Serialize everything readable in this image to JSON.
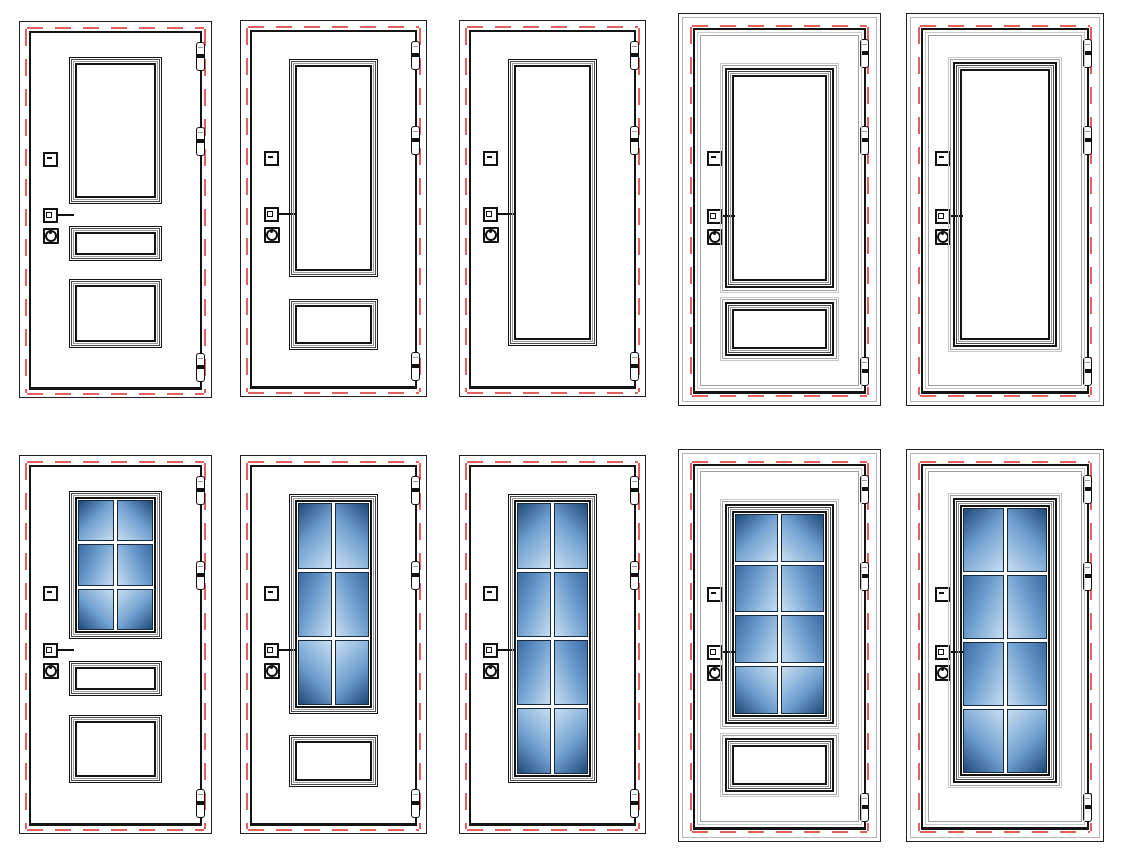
{
  "canvas": {
    "width": 1124,
    "height": 854,
    "background": "#ffffff"
  },
  "image_type": "technical-drawing-catalog",
  "subject": "entry-door-design-variants",
  "grid": {
    "rows": 2,
    "cols": 5
  },
  "colors": {
    "frame_line": "#202020",
    "leaf_line": "#141414",
    "molding_light": "#c8c8c8",
    "molding_mid": "#9f9f9f",
    "ring_dark": "#141414",
    "ring_mid": "#4a4a4a",
    "ring_gray": "#9a9a9a",
    "gasket_red": "#e26060",
    "glass_dark": "#1e4976",
    "glass_middark": "#3a6aa2",
    "glass_mid": "#6f9fcf",
    "glass_light": "#c6ddf1",
    "muntin_white": "#ffffff",
    "hardware_black": "#111111"
  },
  "door_common": {
    "hinge_count": 3,
    "hinge_side": "right",
    "hardware": [
      "latch",
      "lever-handle",
      "cylinder-lock"
    ],
    "hardware_side": "left",
    "seal": "red-dashed-gasket",
    "hinge_tops_pct": [
      2.5,
      26.5,
      90.5
    ],
    "latch_top_pct": 33.5,
    "handle_top_pct": 49.5,
    "lock_top_pct": 55.0
  },
  "doors": [
    {
      "id": 1,
      "name": "door-three-blank-panels",
      "style": "plain",
      "row": 1,
      "col": 1,
      "cell": {
        "x": 19,
        "y": 21,
        "w": 193,
        "h": 377
      },
      "panels": [
        {
          "kind": "blank",
          "top_pct": 6.7,
          "height_pct": 41.6
        },
        {
          "kind": "blank",
          "top_pct": 54.5,
          "height_pct": 9.8
        },
        {
          "kind": "blank",
          "top_pct": 69.6,
          "height_pct": 19.3
        }
      ]
    },
    {
      "id": 2,
      "name": "door-two-blank-panels",
      "style": "plain",
      "row": 1,
      "col": 2,
      "cell": {
        "x": 240,
        "y": 20,
        "w": 187,
        "h": 377
      },
      "panels": [
        {
          "kind": "blank",
          "top_pct": 7.7,
          "height_pct": 61.6
        },
        {
          "kind": "blank",
          "top_pct": 75.4,
          "height_pct": 14.4
        }
      ]
    },
    {
      "id": 3,
      "name": "door-single-tall-blank-panel",
      "style": "plain",
      "row": 1,
      "col": 3,
      "cell": {
        "x": 459,
        "y": 20,
        "w": 187,
        "h": 377
      },
      "panels": [
        {
          "kind": "blank",
          "top_pct": 7.7,
          "height_pct": 81.0
        }
      ]
    },
    {
      "id": 4,
      "name": "door-molded-two-blank-panels",
      "style": "molded",
      "row": 1,
      "col": 4,
      "cell": {
        "x": 678,
        "y": 13,
        "w": 203,
        "h": 393
      },
      "panels": [
        {
          "kind": "blank",
          "top_pct": 5.1,
          "height_pct": 70.0
        },
        {
          "kind": "blank",
          "top_pct": 76.3,
          "height_pct": 19.5
        }
      ]
    },
    {
      "id": 5,
      "name": "door-molded-single-blank-panel",
      "style": "molded",
      "row": 1,
      "col": 5,
      "cell": {
        "x": 906,
        "y": 13,
        "w": 198,
        "h": 393
      },
      "panels": [
        {
          "kind": "blank",
          "top_pct": 3.3,
          "height_pct": 89.6
        }
      ]
    },
    {
      "id": 6,
      "name": "door-glass-2x3-two-blank-panels",
      "style": "plain",
      "row": 2,
      "col": 1,
      "cell": {
        "x": 19,
        "y": 455,
        "w": 193,
        "h": 379
      },
      "panels": [
        {
          "kind": "glass",
          "grid_cols": 2,
          "grid_rows": 3,
          "top_pct": 6.7,
          "height_pct": 41.6
        },
        {
          "kind": "blank",
          "top_pct": 54.5,
          "height_pct": 9.8
        },
        {
          "kind": "blank",
          "top_pct": 69.6,
          "height_pct": 19.3
        }
      ]
    },
    {
      "id": 7,
      "name": "door-glass-2x3-one-blank-panel",
      "style": "plain",
      "row": 2,
      "col": 2,
      "cell": {
        "x": 240,
        "y": 455,
        "w": 187,
        "h": 379
      },
      "panels": [
        {
          "kind": "glass",
          "grid_cols": 2,
          "grid_rows": 3,
          "top_pct": 7.7,
          "height_pct": 61.6
        },
        {
          "kind": "blank",
          "top_pct": 75.4,
          "height_pct": 14.4
        }
      ]
    },
    {
      "id": 8,
      "name": "door-full-glass-2x4",
      "style": "plain",
      "row": 2,
      "col": 3,
      "cell": {
        "x": 459,
        "y": 455,
        "w": 187,
        "h": 379
      },
      "panels": [
        {
          "kind": "glass",
          "grid_cols": 2,
          "grid_rows": 4,
          "top_pct": 7.7,
          "height_pct": 81.0
        }
      ]
    },
    {
      "id": 9,
      "name": "door-molded-glass-2x4-one-blank-panel",
      "style": "molded",
      "row": 2,
      "col": 4,
      "cell": {
        "x": 678,
        "y": 449,
        "w": 203,
        "h": 393
      },
      "panels": [
        {
          "kind": "glass",
          "grid_cols": 2,
          "grid_rows": 4,
          "top_pct": 5.1,
          "height_pct": 70.0
        },
        {
          "kind": "blank",
          "top_pct": 76.3,
          "height_pct": 19.5
        }
      ]
    },
    {
      "id": 10,
      "name": "door-molded-full-glass-2x4",
      "style": "molded",
      "row": 2,
      "col": 5,
      "cell": {
        "x": 906,
        "y": 449,
        "w": 198,
        "h": 393
      },
      "panels": [
        {
          "kind": "glass",
          "grid_cols": 2,
          "grid_rows": 4,
          "top_pct": 3.3,
          "height_pct": 89.6
        }
      ]
    }
  ]
}
